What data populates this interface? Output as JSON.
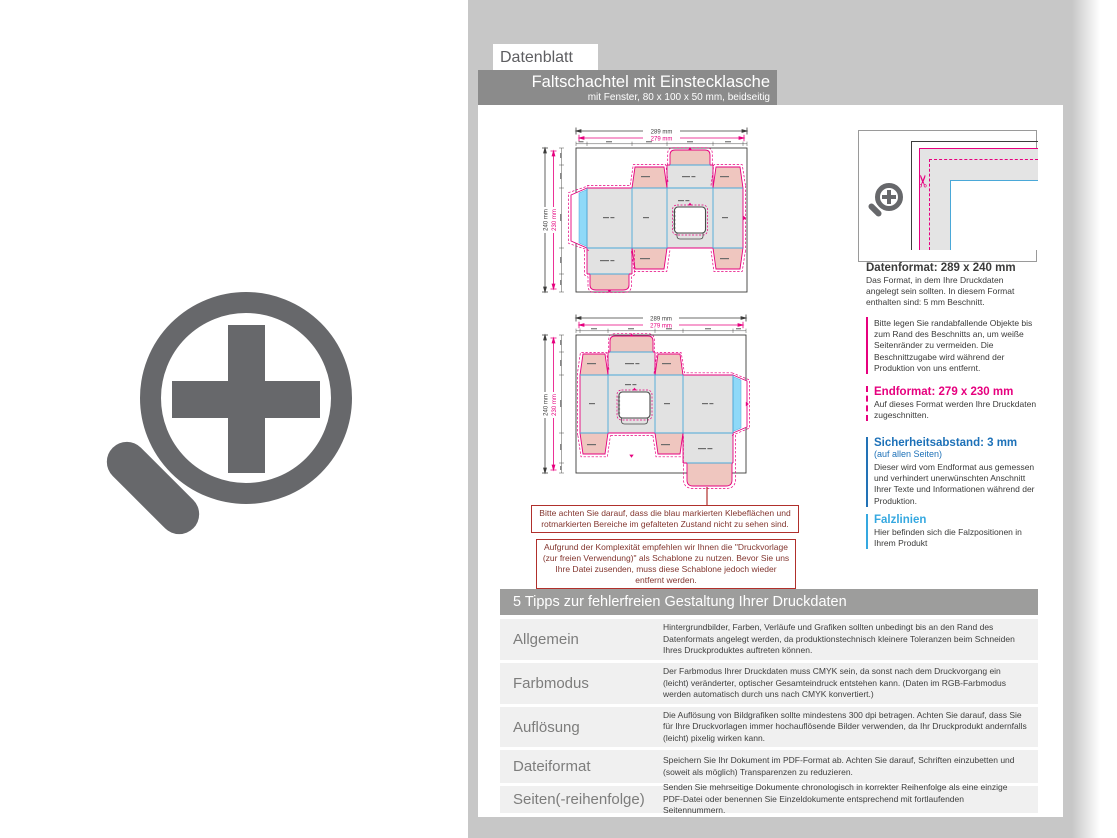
{
  "header": {
    "tab": "Datenblatt",
    "title": "Faltschachtel mit Einstecklasche",
    "subtitle": "mit Fenster, 80 x 100 x 50 mm, beidseitig"
  },
  "drawing_dims": {
    "outer_width": "289 mm",
    "trim_width": "279 mm",
    "outer_height": "240 mm",
    "trim_height": "230 mm"
  },
  "notes": {
    "note1": "Bitte achten Sie darauf, dass die blau markierten Klebeflächen und rotmarkierten Bereiche im gefalteten Zustand nicht zu sehen sind.",
    "note2": "Aufgrund der Komplexität empfehlen wir Ihnen die \"Druckvorlage (zur freien Verwendung)\" als Schablone zu nutzen. Bevor Sie uns Ihre Datei zusenden, muss diese Schablone jedoch wieder entfernt werden."
  },
  "sidebar": {
    "datenformat_heading": "Datenformat: 289 x 240 mm",
    "datenformat_body": "Das Format, in dem Ihre Druckdaten angelegt sein sollten. In diesem Format enthalten sind: 5 mm Beschnitt.",
    "datenformat_note": "Bitte legen Sie randabfallende Objekte bis zum Rand des Beschnitts an, um weiße Seitenränder zu vermeiden. Die Beschnittzugabe wird während der Produktion von uns entfernt.",
    "endformat_heading": "Endformat: 279 x 230 mm",
    "endformat_body": "Auf dieses Format werden Ihre Druckdaten zugeschnitten.",
    "sicherheitsabstand_heading": "Sicherheitsabstand: 3 mm",
    "sicherheitsabstand_sub": "(auf allen Seiten)",
    "sicherheitsabstand_body": "Dieser wird vom Endformat aus gemessen und verhindert unerwünschten Anschnitt Ihrer Texte und Informationen während der Produktion.",
    "falzlinien_heading": "Falzlinien",
    "falzlinien_body": "Hier befinden sich die Falzpositionen in Ihrem Produkt"
  },
  "tips": {
    "heading": "5 Tipps zur fehlerfreien Gestaltung Ihrer Druckdaten",
    "rows": [
      {
        "label": "Allgemein",
        "text": "Hintergrundbilder, Farben, Verläufe und Grafiken sollten unbedingt bis an den Rand des Datenformats angelegt werden, da produktionstechnisch kleinere Toleranzen beim Schneiden Ihres Druckproduktes auftreten können."
      },
      {
        "label": "Farbmodus",
        "text": "Der Farbmodus Ihrer Druckdaten muss CMYK sein, da sonst nach dem Druckvorgang ein (leicht) veränderter, optischer Gesamteindruck entstehen kann. (Daten im RGB-Farbmodus werden automatisch durch uns nach CMYK konvertiert.)"
      },
      {
        "label": "Auflösung",
        "text": "Die Auflösung von Bildgrafiken sollte mindestens 300 dpi betragen. Achten Sie darauf, dass Sie für Ihre Druckvorlagen immer hochauflösende Bilder verwenden, da Ihr Druckprodukt andernfalls (leicht) pixelig wirken kann."
      },
      {
        "label": "Dateiformat",
        "text": "Speichern Sie Ihr Dokument im PDF-Format ab. Achten Sie darauf, Schriften einzubetten und (soweit als möglich) Transparenzen zu reduzieren."
      },
      {
        "label": "Seiten(-reihenfolge)",
        "text": "Senden Sie mehrseitige Dokumente chronologisch in korrekter Reihenfolge als eine einzige PDF-Datei oder benennen Sie Einzeldokumente entsprechend mit fortlaufenden Seitennummern."
      }
    ]
  },
  "colors": {
    "magenta": "#e6007e",
    "fold_blue": "#4aa8d8",
    "safety_blue": "#1d71b8",
    "falz_cyan": "#35a8e0",
    "note_red": "#b0302c",
    "panel_gray": "#e2e2e2",
    "flap_pink": "#efc6bf",
    "glue_blue": "#8fd9f8"
  }
}
